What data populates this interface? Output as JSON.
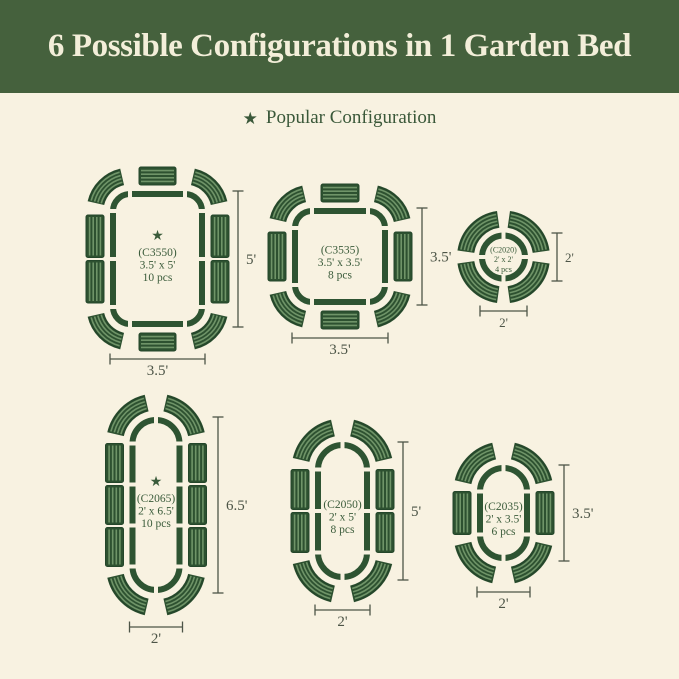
{
  "header": {
    "title": "6 Possible Configurations in 1 Garden Bed"
  },
  "legend": {
    "label": "Popular Configuration"
  },
  "icons": {
    "popular_star": "★"
  },
  "colors": {
    "background": "#f8f2e1",
    "header_bg": "#45613d",
    "header_text": "#f3eed9",
    "outline_green": "#2e5432",
    "panel_base": "#2d5130",
    "panel_stripe": "#6f9468",
    "panel_border": "#24462a",
    "text_green": "#3a5b3a",
    "dim_color": "#4d5547"
  },
  "configurations": [
    {
      "code": "(C3550)",
      "size": "3.5' x 5'",
      "pieces": "10 pcs",
      "popular": true,
      "shape": "rounded-rectangle",
      "width_label": "3.5'",
      "height_label": "5'"
    },
    {
      "code": "(C3535)",
      "size": "3.5' x 3.5'",
      "pieces": "8 pcs",
      "popular": false,
      "shape": "rounded-square",
      "width_label": "3.5'",
      "height_label": "3.5'"
    },
    {
      "code": "(C2020)",
      "size": "2' x 2'",
      "pieces": "4 pcs",
      "popular": false,
      "shape": "circle",
      "width_label": "2'",
      "height_label": "2'"
    },
    {
      "code": "(C2065)",
      "size": "2' x 6.5'",
      "pieces": "10 pcs",
      "popular": true,
      "shape": "pill",
      "width_label": "2'",
      "height_label": "6.5'"
    },
    {
      "code": "(C2050)",
      "size": "2' x 5'",
      "pieces": "8 pcs",
      "popular": false,
      "shape": "pill",
      "width_label": "2'",
      "height_label": "5'"
    },
    {
      "code": "(C2035)",
      "size": "2' x 3.5'",
      "pieces": "6 pcs",
      "popular": false,
      "shape": "pill",
      "width_label": "2'",
      "height_label": "3.5'"
    }
  ]
}
